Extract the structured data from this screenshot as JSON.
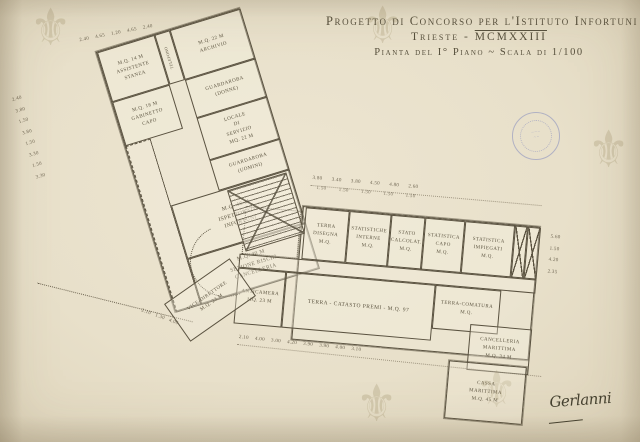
{
  "title_block": {
    "line1": "Progetto di Concorso per l'Istituto Infortuni",
    "line2_prefix": "Trieste - ",
    "line2_year": "MCMXXIII",
    "line3": "Pianta del I° Piano ~ Scala di 1/100"
  },
  "rooms": {
    "assistente": {
      "lines": [
        "M.Q. 14 M",
        "ASSISTENTE",
        "STANZA"
      ]
    },
    "telefono": {
      "lines": [
        "TELEFONO"
      ]
    },
    "archivio": {
      "lines": [
        "M.Q. 22 M",
        "ARCHIVIO"
      ]
    },
    "gabinetto_capo": {
      "lines": [
        "M.Q. 18 M",
        "GABINETTO",
        "CAPO"
      ]
    },
    "guardaroba_donne": {
      "lines": [
        "GUARDAROBA",
        "(DONNE)"
      ]
    },
    "locale_servizio": {
      "lines": [
        "LOCALE",
        "DI",
        "SERVIZIO",
        "MQ. 22 M"
      ]
    },
    "guardaroba_uomini": {
      "lines": [
        "GUARDAROBA",
        "(UOMINI)"
      ]
    },
    "ispettorato": {
      "lines": [
        "M.Q. 46 M",
        "ISPETTORATO",
        "INFORTUNI"
      ]
    },
    "sezione_rischi": {
      "lines": [
        "M.Q. 40 M",
        "SEZIONE RISCHI",
        "CANCELLERIA"
      ]
    },
    "vice_direttore": {
      "lines": [
        "VICE-DIRETTORE",
        "M.Q. 23 M"
      ]
    },
    "terra_disegna": {
      "lines": [
        "TERRA",
        "DISEGNA",
        "M.Q."
      ]
    },
    "statistiche_interne": {
      "lines": [
        "STATISTICHE",
        "INTERNE",
        "M.Q."
      ]
    },
    "stato_calcolat": {
      "lines": [
        "STATO",
        "CALCOLAT.",
        "M.Q."
      ]
    },
    "statistica_capo": {
      "lines": [
        "STATISTICA",
        "CAPO",
        "M.Q."
      ]
    },
    "statistica_impiegati": {
      "lines": [
        "STATISTICA",
        "IMPIEGATI",
        "M.Q."
      ]
    },
    "anticamera": {
      "lines": [
        "ANTICAMERA",
        "MQ. 23 M"
      ]
    },
    "catasto_premi": {
      "lines": [
        "TERRA - CATASTO PREMI - M.Q. 97"
      ]
    },
    "terra_comatura": {
      "lines": [
        "TERRA-COMATURA",
        "M.Q."
      ]
    },
    "cancelleria_marittima": {
      "lines": [
        "CANCELLERIA",
        "MARITTIMA",
        "M.Q. 34 M"
      ]
    },
    "cassa_marittima": {
      "lines": [
        "CASSA",
        "MARITTIMA",
        "M.Q. 45 M"
      ]
    }
  },
  "dims": {
    "head_chain": "2.40    4.65    1.20    4.65    2.40",
    "left_chain": [
      "2.40",
      "3.80",
      "1.50",
      "3.80",
      "1.50",
      "3.30",
      "1.50",
      "3.30"
    ],
    "top_chain": "3.80      3.40      3.80      4.50      4.80      2.60",
    "top_windows": "1.50        1.50        1.50        1.50        1.50",
    "bottom_chain": "2.10    4.00    3.00    4.20    3.90    3.90    4.00    3.10",
    "right_chain": [
      "5.60",
      "1.50",
      "4.20",
      "2.35"
    ],
    "corner_chain": "2.10   1.30   4.00"
  },
  "signature": "Gerlanni",
  "watermark_glyph": "⚜",
  "colors": {
    "paper": "#e8e0ca",
    "ink": "#57503d",
    "stamp_blue": "#6a74b9",
    "watermark": "#9e8f68"
  }
}
